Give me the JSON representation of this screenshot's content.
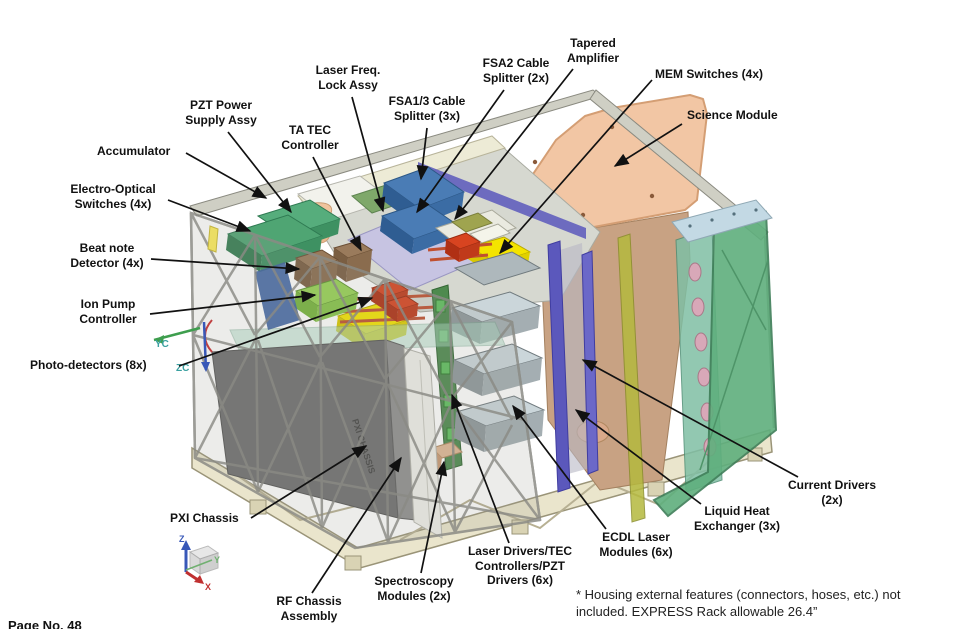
{
  "callouts": [
    {
      "id": "laser-freq-lock-assy",
      "text": "Laser Freq.\nLock Assy"
    },
    {
      "id": "fsa13-cable-splitter",
      "text": "FSA1/3 Cable\nSplitter (3x)"
    },
    {
      "id": "fsa2-cable-splitter",
      "text": "FSA2 Cable\nSplitter (2x)"
    },
    {
      "id": "tapered-amplifier",
      "text": "Tapered\nAmplifier"
    },
    {
      "id": "mem-switches",
      "text": "MEM Switches (4x)"
    },
    {
      "id": "science-module",
      "text": "Science Module"
    },
    {
      "id": "pzt-power-supply-assy",
      "text": "PZT Power\nSupply Assy"
    },
    {
      "id": "ta-tec-controller",
      "text": "TA TEC\nController"
    },
    {
      "id": "accumulator",
      "text": "Accumulator"
    },
    {
      "id": "electro-optical-switches",
      "text": "Electro-Optical\nSwitches (4x)"
    },
    {
      "id": "beat-note-detector",
      "text": "Beat note\nDetector (4x)"
    },
    {
      "id": "ion-pump-controller",
      "text": "Ion Pump\nController"
    },
    {
      "id": "photo-detectors",
      "text": "Photo-detectors (8x)"
    },
    {
      "id": "pxi-chassis",
      "text": "PXI Chassis"
    },
    {
      "id": "rf-chassis-assembly",
      "text": "RF Chassis\nAssembly"
    },
    {
      "id": "spectroscopy-modules",
      "text": "Spectroscopy\nModules (2x)"
    },
    {
      "id": "laser-drivers",
      "text": "Laser Drivers/TEC\nControllers/PZT\nDrivers (6x)"
    },
    {
      "id": "ecdl-laser-modules",
      "text": "ECDL Laser\nModules (6x)"
    },
    {
      "id": "liquid-heat-exchanger",
      "text": "Liquid Heat\nExchanger (3x)"
    },
    {
      "id": "current-drivers",
      "text": "Current Drivers\n(2x)"
    }
  ],
  "footnote": "* Housing external features (connectors, hoses, etc.) not\nincluded.  EXPRESS Rack allowable 26.4”",
  "page_number": "Page No. 48",
  "model": {
    "pxi_box_text": "PXI CHASSIS"
  },
  "triads": {
    "yc": "YC",
    "zc": "ZC",
    "x": "X",
    "y": "Y",
    "z": "Z"
  },
  "palette": {
    "science_module_top": "#F2C6A4",
    "science_module_side": "#C8A283",
    "heat_exchanger_panel": "#5FAF7D",
    "purple_rails": "#5B58BC",
    "fsa_splitter_blue": "#4A7CB5",
    "mem_switch_yellow": "#F4E400",
    "photo_detector_red": "#D04020",
    "eo_switch_green": "#4FA573",
    "ion_pump_green": "#97D355",
    "beat_note_brown": "#9A7B5C",
    "lavender_panel": "#C7C4E2",
    "base_cream": "#EAE5CC",
    "truss_gray": "#8B8B85",
    "pxi_dark_gray": "#6F6F6F"
  }
}
